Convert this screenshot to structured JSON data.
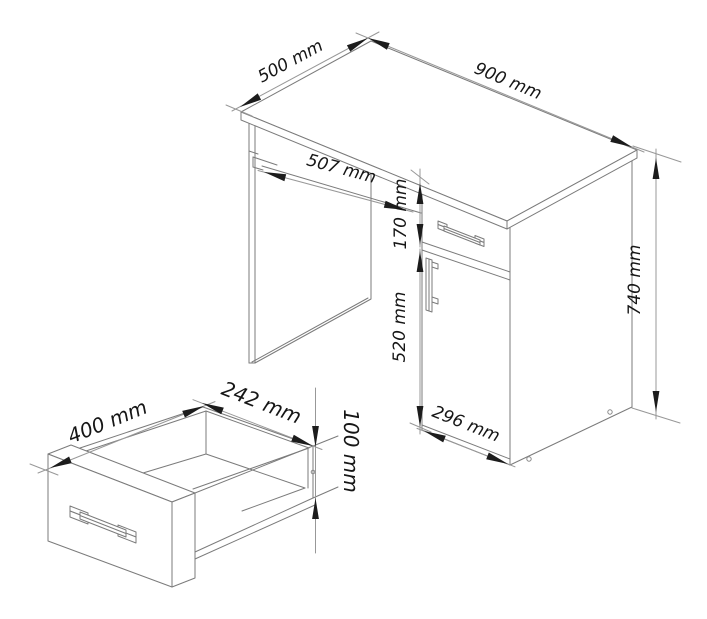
{
  "drawing": {
    "type": "furniture-technical-drawing",
    "units": "mm",
    "background_color": "#ffffff",
    "line_color": "#7b7b7b",
    "dimension_line_color": "#989898",
    "text_color": "#161616"
  },
  "desk_view": {
    "name": "assembled desk isometric view",
    "dims": {
      "depth": "500 mm",
      "width": "900 mm",
      "tray_width": "507 mm",
      "drawer_front_height": "170 mm",
      "door_height": "520 mm",
      "total_height": "740 mm",
      "cabinet_width": "296 mm"
    }
  },
  "drawer_view": {
    "name": "drawer detail isometric view",
    "dims": {
      "depth": "400 mm",
      "inner_width": "242 mm",
      "height": "100 mm"
    }
  }
}
